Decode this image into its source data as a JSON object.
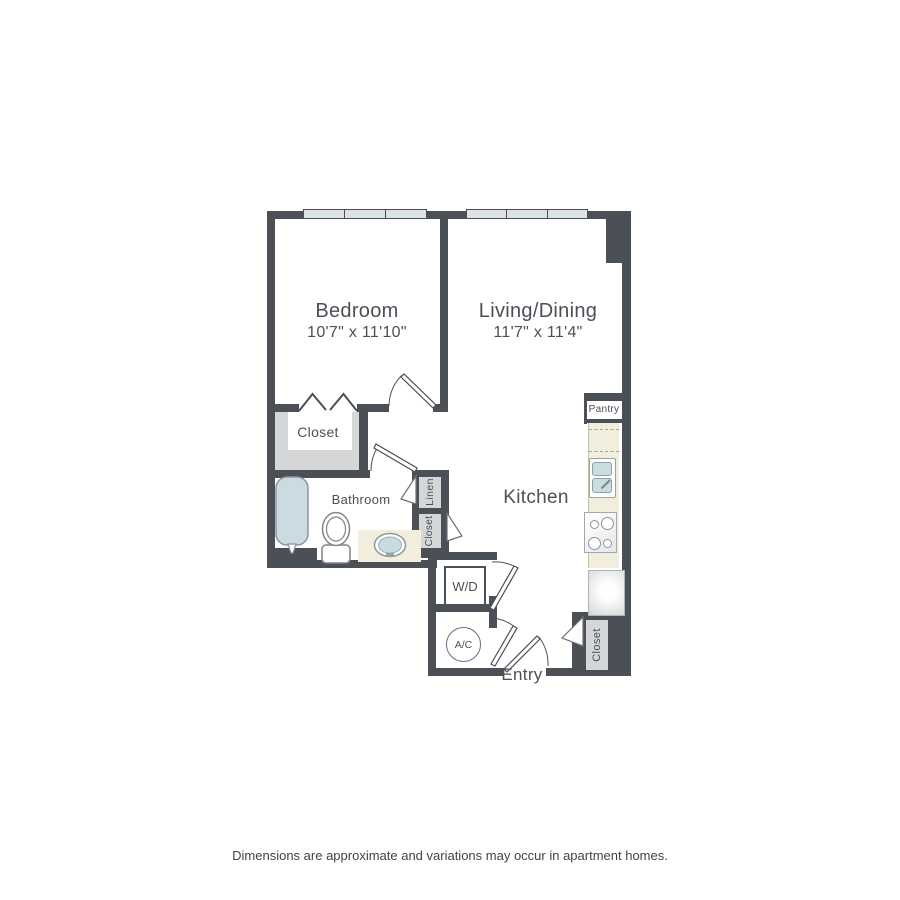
{
  "plan": {
    "rooms": {
      "bedroom": {
        "label": "Bedroom",
        "dimensions": "10'7\" x 11'10\""
      },
      "living_dining": {
        "label": "Living/Dining",
        "dimensions": "11'7\" x 11'4\""
      },
      "kitchen": {
        "label": "Kitchen"
      },
      "bathroom": {
        "label": "Bathroom"
      },
      "entry": {
        "label": "Entry"
      }
    },
    "closets": {
      "bedroom_closet": {
        "label": "Closet"
      },
      "linen": {
        "label": "Linen"
      },
      "hall_closet": {
        "label": "Closet"
      },
      "entry_closet": {
        "label": "Closet"
      },
      "pantry": {
        "label": "Pantry"
      }
    },
    "utilities": {
      "washer_dryer": {
        "label": "W/D"
      },
      "air_conditioner": {
        "label": "A/C"
      }
    },
    "fixtures": [
      "bathtub",
      "toilet",
      "vanity-sink",
      "kitchen-sink",
      "stove",
      "refrigerator"
    ],
    "colors": {
      "wall": "#4b5056",
      "text": "#4b5056",
      "window_fill": "#dce3e7",
      "closet_fill": "#d5d6d8",
      "counter_fill": "#f1eedd",
      "fixture_blue": "#ccdce3",
      "counter_dash": "#b3a57f"
    }
  },
  "footer": {
    "disclaimer": "Dimensions are approximate and variations may occur in apartment homes."
  }
}
